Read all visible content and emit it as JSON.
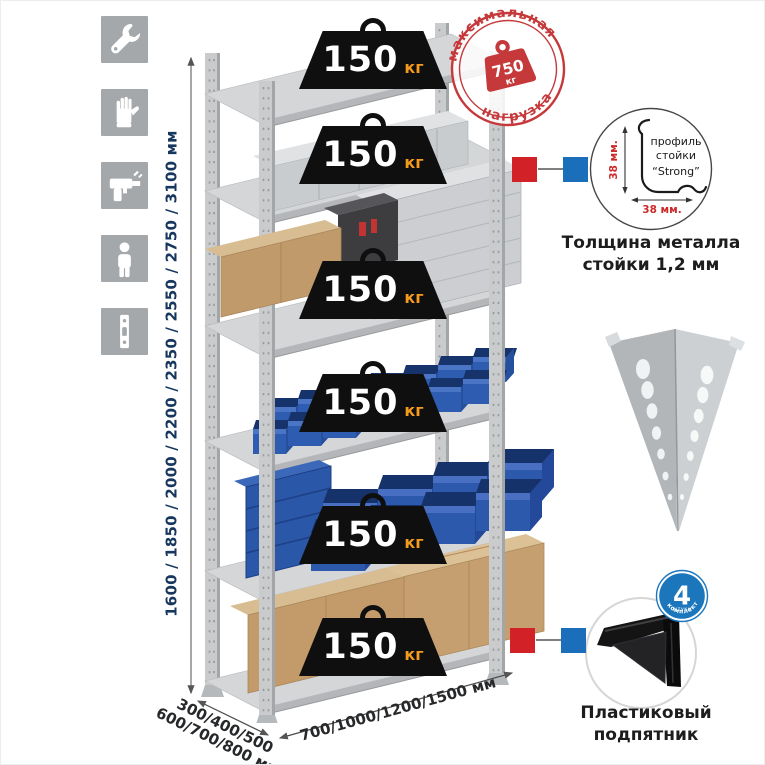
{
  "sidebar": {
    "icons": [
      {
        "name": "wrench"
      },
      {
        "name": "gloves"
      },
      {
        "name": "drill"
      },
      {
        "name": "person"
      },
      {
        "name": "rack-post"
      }
    ]
  },
  "stamp": {
    "arc_top": "максимальная",
    "arc_bottom": "нагрузка",
    "value": "750",
    "unit": "кг"
  },
  "shelf_load": {
    "value": "150",
    "unit": "кг"
  },
  "dimensions": {
    "height": "1600 / 1850 / 2000 / 2200 / 2350 / 2550 / 2750 / 3100 мм",
    "depth_line1": "300/400/500",
    "depth_line2": "600/700/800 мм",
    "width": "700/1000/1200/1500 мм"
  },
  "profile": {
    "line1": "профиль",
    "line2": "стойки",
    "line3": "“Strong”",
    "dim_v": "38 мм.",
    "dim_h": "38 мм.",
    "caption1": "Толщина металла",
    "caption2": "стойки 1,2 мм"
  },
  "foot": {
    "caption1": "Пластиковый",
    "caption2": "подпятник",
    "badge_value": "4",
    "badge_sub": "штуки",
    "badge_arc": "в комплекте"
  },
  "colors": {
    "accent_red": "#c5393b",
    "marker_red": "#d32128",
    "marker_blue": "#1b6fba",
    "badge_blue": "#1b76bc",
    "dim_text": "#17375e",
    "unit_orange": "#f49a1c"
  }
}
